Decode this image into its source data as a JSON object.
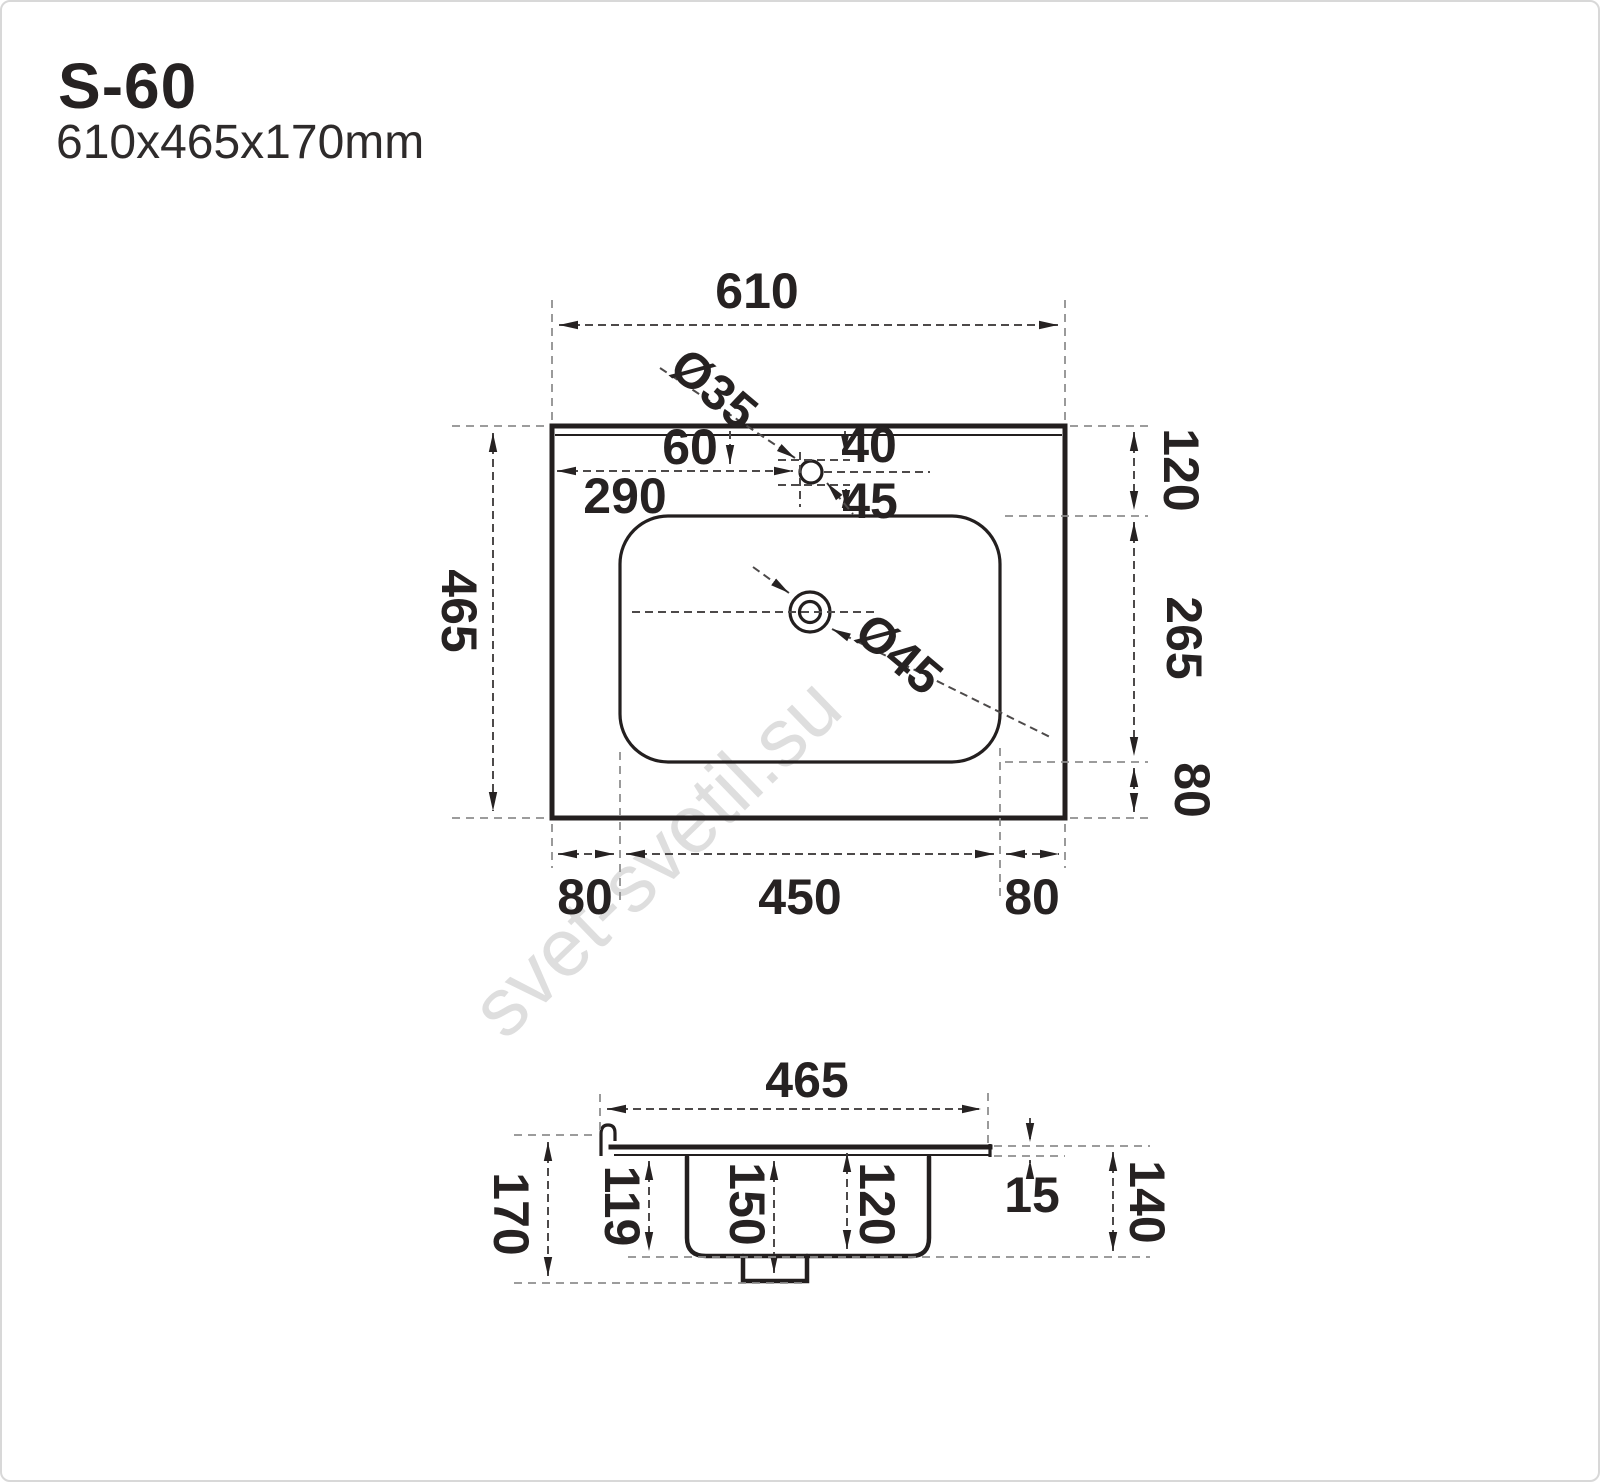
{
  "header": {
    "model": "S-60",
    "size": "610x465x170mm"
  },
  "watermark": {
    "text": "svet-svetil.su"
  },
  "top_view": {
    "width": "610",
    "height": "465",
    "faucet": {
      "diameter": "Ø35",
      "from_left": "290",
      "from_top": "60",
      "to_hole_top": "40",
      "to_basin": "45"
    },
    "drain": {
      "diameter": "Ø45"
    },
    "right": {
      "margin_top": "120",
      "basin_height": "265",
      "margin_bottom": "80"
    },
    "bottom": {
      "margin_left": "80",
      "basin_width": "450",
      "margin_right": "80"
    }
  },
  "section_view": {
    "width": "465",
    "total_height": "170",
    "outer_depth": "119",
    "drain_depth": "150",
    "inner_depth": "120",
    "top_thickness": "15",
    "bowl_height": "140"
  }
}
